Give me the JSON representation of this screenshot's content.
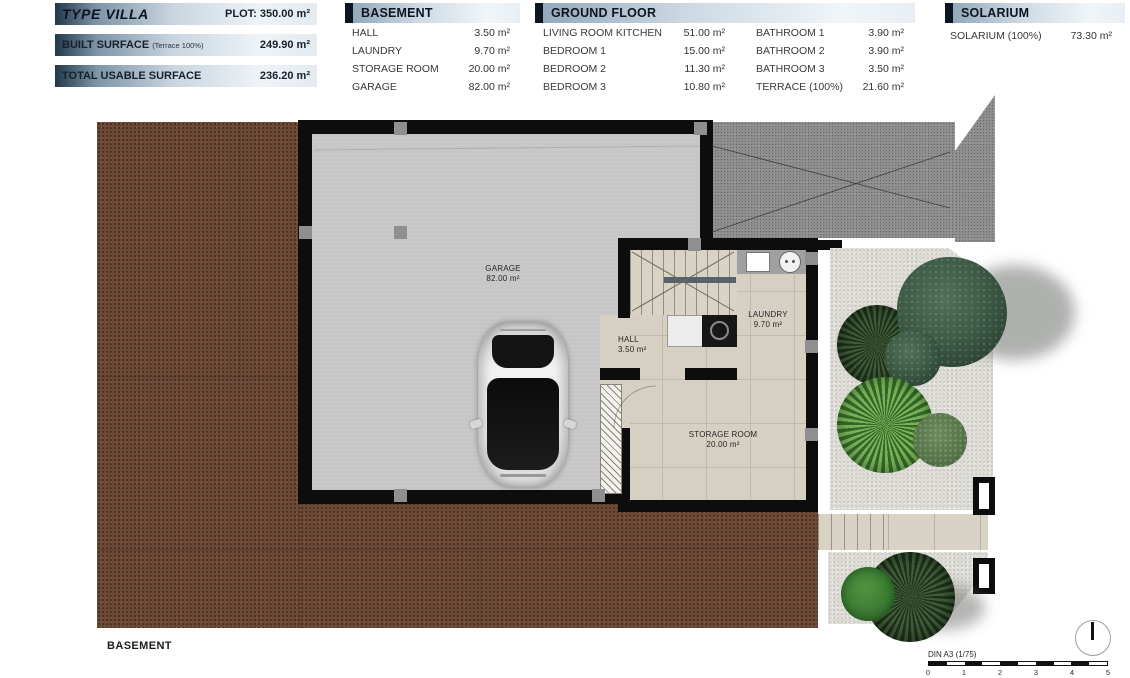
{
  "header": {
    "type_label": "TYPE VILLA",
    "plot_label": "PLOT: 350.00 m²",
    "built_surface_label": "BUILT SURFACE",
    "built_surface_note": "(Terrace 100%)",
    "built_surface_value": "249.90 m²",
    "total_usable_label": "TOTAL USABLE SURFACE",
    "total_usable_value": "236.20 m²"
  },
  "tables": {
    "basement": {
      "title": "BASEMENT",
      "rows": [
        {
          "label": "HALL",
          "value": "3.50 m²"
        },
        {
          "label": "LAUNDRY",
          "value": "9.70 m²"
        },
        {
          "label": "STORAGE ROOM",
          "value": "20.00 m²"
        },
        {
          "label": "GARAGE",
          "value": "82.00 m²"
        }
      ]
    },
    "ground_floor": {
      "title": "GROUND FLOOR",
      "left": [
        {
          "label": "LIVING ROOM KITCHEN",
          "value": "51.00 m²"
        },
        {
          "label": "BEDROOM 1",
          "value": "15.00 m²"
        },
        {
          "label": "BEDROOM 2",
          "value": "11.30 m²"
        },
        {
          "label": "BEDROOM 3",
          "value": "10.80 m²"
        }
      ],
      "right": [
        {
          "label": "BATHROOM 1",
          "value": "3.90 m²"
        },
        {
          "label": "BATHROOM 2",
          "value": "3.90 m²"
        },
        {
          "label": "BATHROOM 3",
          "value": "3.50 m²"
        },
        {
          "label": "TERRACE (100%)",
          "value": "21.60 m²"
        }
      ]
    },
    "solarium": {
      "title": "SOLARIUM",
      "rows": [
        {
          "label": "SOLARIUM (100%)",
          "value": "73.30 m²"
        }
      ]
    }
  },
  "plan": {
    "floor_title": "BASEMENT",
    "rooms": {
      "garage": {
        "name": "GARAGE",
        "area": "82.00 m²"
      },
      "hall": {
        "name": "HALL",
        "area": "3.50 m²"
      },
      "laundry": {
        "name": "LAUNDRY",
        "area": "9.70 m²"
      },
      "storage": {
        "name": "STORAGE ROOM",
        "area": "20.00 m²"
      }
    }
  },
  "footer": {
    "scale_label": "DIN A3 (1/75)",
    "scale_ticks": [
      "0",
      "1",
      "2",
      "3",
      "4",
      "5"
    ]
  },
  "colors": {
    "header_bar_dark": "#22384a",
    "terrain": "#6b4936",
    "asphalt": "#8e8e8e",
    "garage_floor": "#c8c8c8",
    "interior_floor": "#d6d0c3",
    "gravel": "#dedcd7",
    "wall": "#0d0d0d"
  }
}
